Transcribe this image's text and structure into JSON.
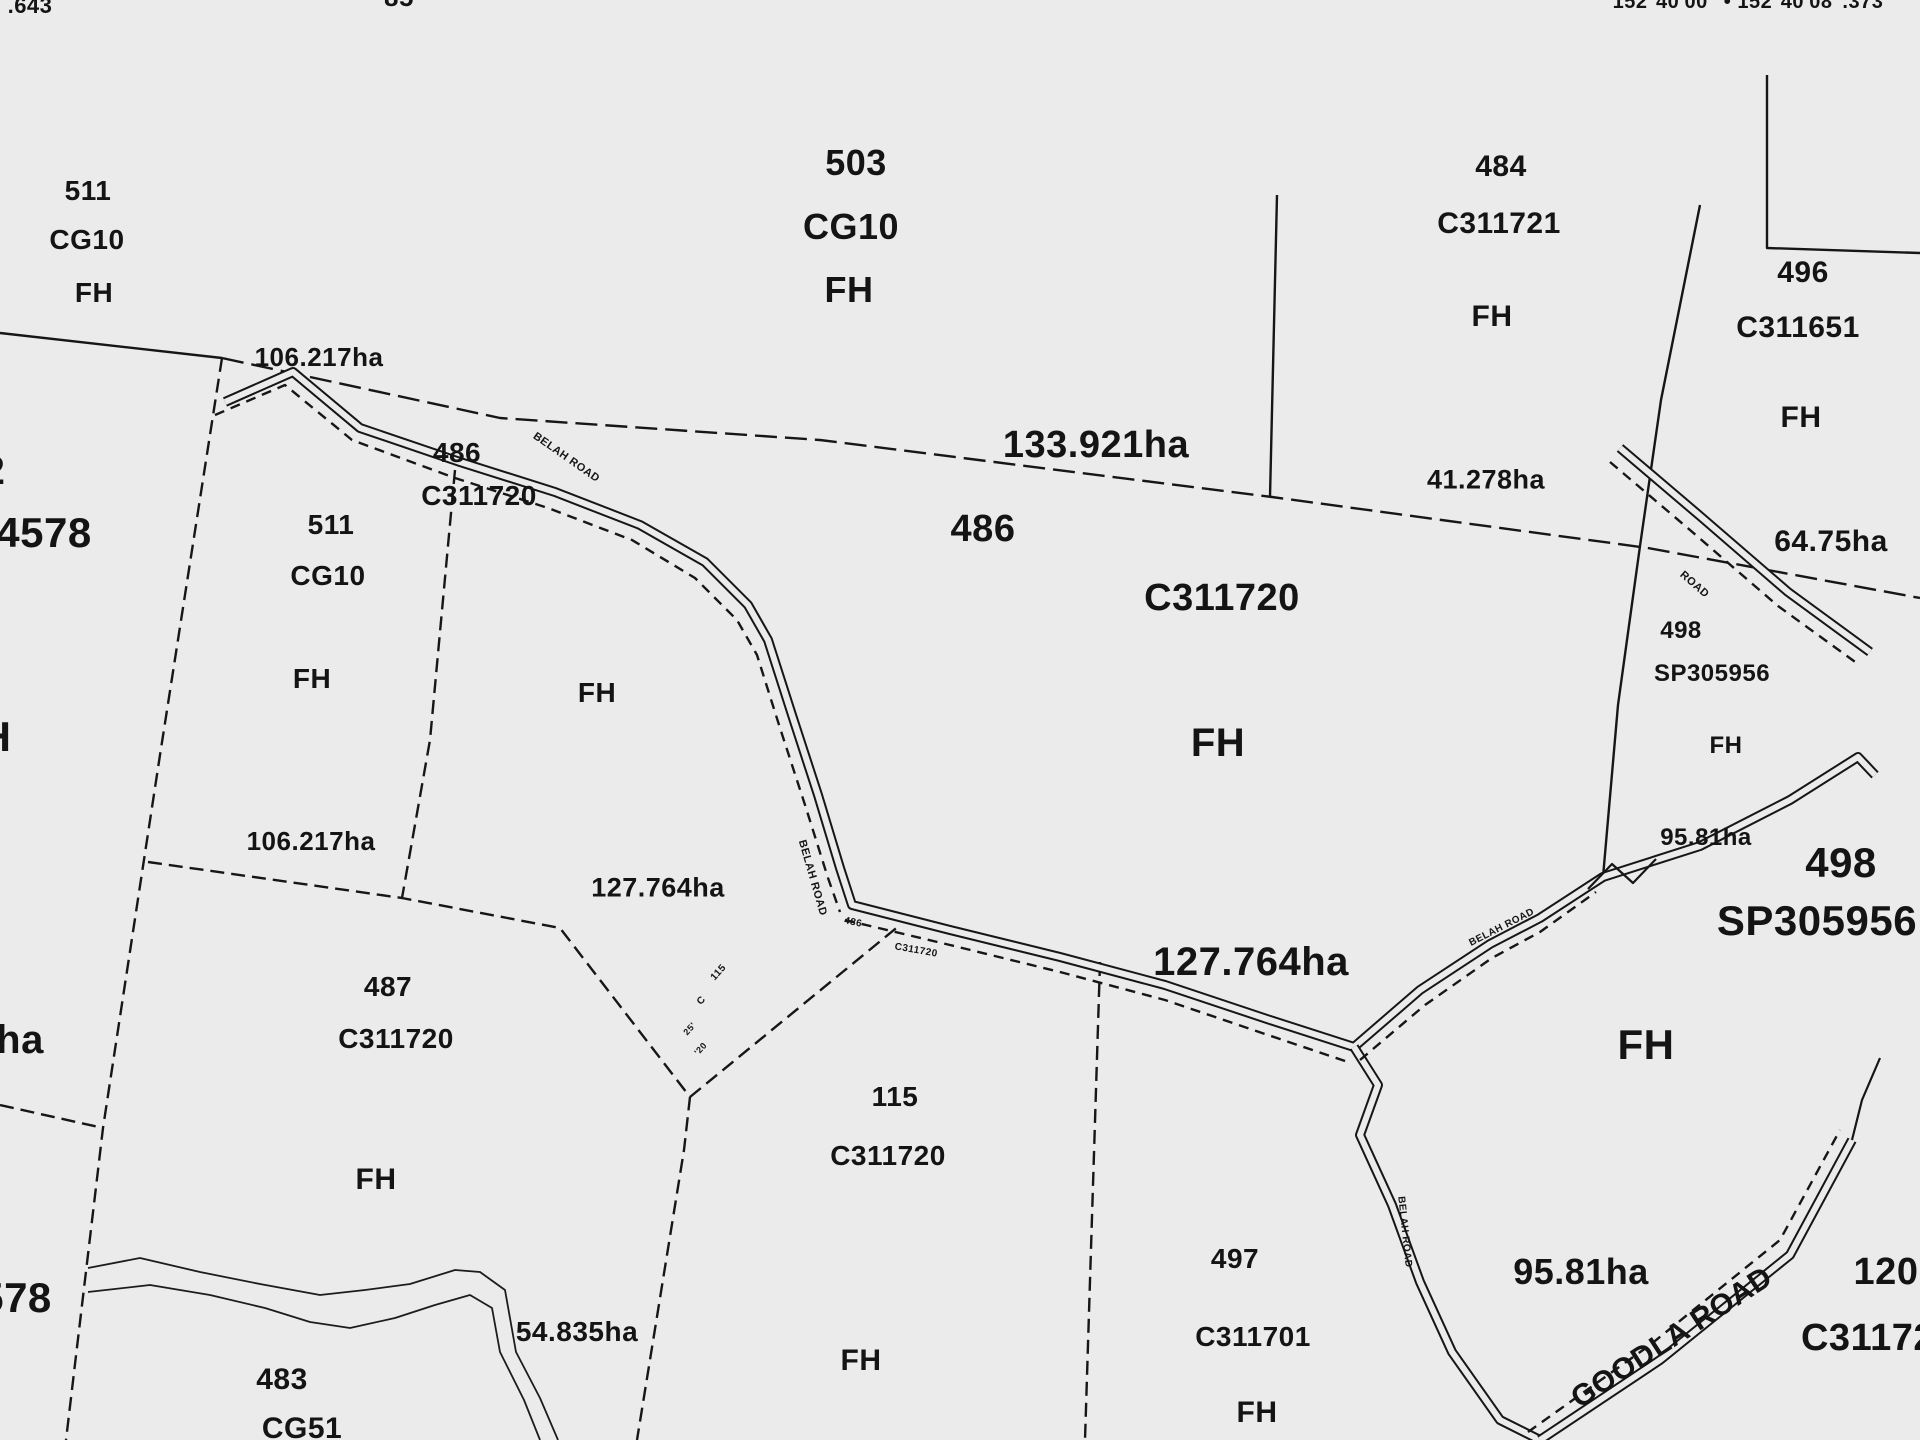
{
  "map_type": "cadastral parcel map",
  "ink_color": "#141414",
  "paper_color": "#ebebeb",
  "top_annotations": {
    "west_coordinate_fragment": ".643",
    "lot_fragment": "85",
    "north_arrow_fragment": "N",
    "longitude_labels": "152°40'00\" • 152°40'08\".373"
  },
  "parcels": [
    {
      "lot": "511",
      "plan": "CG10",
      "tenure": "FH",
      "area": "106.217ha"
    },
    {
      "lot": "503",
      "plan": "CG10",
      "tenure": "FH"
    },
    {
      "lot": "484",
      "plan": "C311721",
      "tenure": "FH"
    },
    {
      "lot": "496",
      "plan": "C311651",
      "tenure": "FH"
    },
    {
      "lot": "511",
      "plan": "CG10",
      "tenure": "FH",
      "area": "106.217ha"
    },
    {
      "lot": "486",
      "plan": "C311720",
      "tenure": "FH",
      "area": "133.921ha"
    },
    {
      "lot": "487",
      "plan": "C311720",
      "tenure": "FH",
      "area": "127.764ha"
    },
    {
      "lot": "115",
      "plan": "C311720",
      "tenure": "FH",
      "area": "54.835ha"
    },
    {
      "lot": "497",
      "plan": "C311701",
      "tenure": "FH",
      "area": "95.81ha"
    },
    {
      "lot": "498",
      "plan": "SP305956",
      "tenure": "FH",
      "area": "95.81ha"
    },
    {
      "lot": "483",
      "plan": "CG51"
    },
    {
      "lot": "120",
      "plan": "C31172"
    }
  ],
  "area_annotations": [
    "106.217ha",
    "133.921ha",
    "41.278ha",
    "64.75ha",
    "106.217ha",
    "127.764ha",
    "127.764ha",
    "95.81ha",
    "95.81ha",
    "54.835ha"
  ],
  "road_names": [
    "BELAH ROAD",
    "GOODLA ROAD"
  ],
  "labels": [
    {
      "n": "coord-fragment-west",
      "t": ".643",
      "x": 30,
      "y": 6,
      "s": 22
    },
    {
      "n": "lot-fragment-85",
      "t": "85",
      "x": 399,
      "y": -3,
      "s": 26
    },
    {
      "n": "north-arrow-icon",
      "t": "N",
      "x": 1057,
      "y": -16,
      "s": 46
    },
    {
      "n": "longitude-coordinates",
      "t": "152°40'00\" • 152°40'08\".373",
      "x": 1748,
      "y": 2,
      "s": 20
    },
    {
      "n": "parcel-511a-lot",
      "t": "511",
      "x": 88,
      "y": 191,
      "s": 28
    },
    {
      "n": "parcel-511a-plan",
      "t": "CG10",
      "x": 87,
      "y": 240,
      "s": 28
    },
    {
      "n": "parcel-511a-tenure",
      "t": "FH",
      "x": 94,
      "y": 293,
      "s": 28
    },
    {
      "n": "parcel-503-lot",
      "t": "503",
      "x": 856,
      "y": 163,
      "s": 36
    },
    {
      "n": "parcel-503-plan",
      "t": "CG10",
      "x": 851,
      "y": 227,
      "s": 36
    },
    {
      "n": "parcel-503-tenure",
      "t": "FH",
      "x": 849,
      "y": 290,
      "s": 36
    },
    {
      "n": "parcel-484-lot",
      "t": "484",
      "x": 1501,
      "y": 167,
      "s": 30
    },
    {
      "n": "parcel-484-plan",
      "t": "C311721",
      "x": 1499,
      "y": 224,
      "s": 30
    },
    {
      "n": "parcel-484-tenure",
      "t": "FH",
      "x": 1492,
      "y": 317,
      "s": 30
    },
    {
      "n": "parcel-496-lot",
      "t": "496",
      "x": 1803,
      "y": 273,
      "s": 30
    },
    {
      "n": "parcel-496-plan",
      "t": "C311651",
      "x": 1798,
      "y": 328,
      "s": 30
    },
    {
      "n": "parcel-496-tenure",
      "t": "FH",
      "x": 1801,
      "y": 418,
      "s": 30
    },
    {
      "n": "parcel-511b-lot",
      "t": "511",
      "x": 331,
      "y": 525,
      "s": 28
    },
    {
      "n": "parcel-511b-plan",
      "t": "CG10",
      "x": 328,
      "y": 576,
      "s": 28
    },
    {
      "n": "parcel-511b-tenure",
      "t": "FH",
      "x": 312,
      "y": 679,
      "s": 28
    },
    {
      "n": "parcel-486w-lot",
      "t": "486",
      "x": 457,
      "y": 453,
      "s": 28
    },
    {
      "n": "parcel-486w-plan",
      "t": "C311720",
      "x": 479,
      "y": 496,
      "s": 28
    },
    {
      "n": "parcel-486w-tenure",
      "t": "FH",
      "x": 597,
      "y": 693,
      "s": 28
    },
    {
      "n": "parcel-486-lot",
      "t": "486",
      "x": 983,
      "y": 529,
      "s": 38
    },
    {
      "n": "parcel-486-plan",
      "t": "C311720",
      "x": 1222,
      "y": 598,
      "s": 38
    },
    {
      "n": "parcel-486-tenure",
      "t": "FH",
      "x": 1218,
      "y": 743,
      "s": 40
    },
    {
      "n": "parcel-487-lot",
      "t": "487",
      "x": 388,
      "y": 987,
      "s": 28
    },
    {
      "n": "parcel-487-plan",
      "t": "C311720",
      "x": 396,
      "y": 1039,
      "s": 28
    },
    {
      "n": "parcel-487-tenure",
      "t": "FH",
      "x": 376,
      "y": 1180,
      "s": 30
    },
    {
      "n": "parcel-115-lot",
      "t": "115",
      "x": 895,
      "y": 1097,
      "s": 28
    },
    {
      "n": "parcel-115-plan",
      "t": "C311720",
      "x": 888,
      "y": 1156,
      "s": 28
    },
    {
      "n": "parcel-115-tenure",
      "t": "FH",
      "x": 861,
      "y": 1361,
      "s": 30
    },
    {
      "n": "parcel-497-lot",
      "t": "497",
      "x": 1235,
      "y": 1259,
      "s": 28
    },
    {
      "n": "parcel-497-plan",
      "t": "C311701",
      "x": 1253,
      "y": 1337,
      "s": 28
    },
    {
      "n": "parcel-497-tenure",
      "t": "FH",
      "x": 1257,
      "y": 1413,
      "s": 30
    },
    {
      "n": "parcel-498a-lot",
      "t": "498",
      "x": 1681,
      "y": 631,
      "s": 24
    },
    {
      "n": "parcel-498a-plan",
      "t": "SP305956",
      "x": 1712,
      "y": 674,
      "s": 24
    },
    {
      "n": "parcel-498a-tenure",
      "t": "FH",
      "x": 1726,
      "y": 746,
      "s": 24
    },
    {
      "n": "parcel-498b-lot",
      "t": "498",
      "x": 1841,
      "y": 863,
      "s": 42
    },
    {
      "n": "parcel-498b-plan",
      "t": "SP305956",
      "x": 1817,
      "y": 921,
      "s": 42
    },
    {
      "n": "parcel-498b-tenure",
      "t": "FH",
      "x": 1646,
      "y": 1045,
      "s": 42
    },
    {
      "n": "parcel-483-lot",
      "t": "483",
      "x": 282,
      "y": 1380,
      "s": 30
    },
    {
      "n": "parcel-483-plan",
      "t": "CG51",
      "x": 302,
      "y": 1429,
      "s": 30
    },
    {
      "n": "area-106a",
      "t": "106.217ha",
      "x": 319,
      "y": 357,
      "s": 26
    },
    {
      "n": "area-106b",
      "t": "106.217ha",
      "x": 311,
      "y": 841,
      "s": 26
    },
    {
      "n": "area-133",
      "t": "133.921ha",
      "x": 1096,
      "y": 445,
      "s": 38
    },
    {
      "n": "area-41",
      "t": "41.278ha",
      "x": 1486,
      "y": 480,
      "s": 27
    },
    {
      "n": "area-64",
      "t": "64.75ha",
      "x": 1831,
      "y": 542,
      "s": 30
    },
    {
      "n": "area-127a",
      "t": "127.764ha",
      "x": 658,
      "y": 888,
      "s": 27
    },
    {
      "n": "area-127b",
      "t": "127.764ha",
      "x": 1251,
      "y": 962,
      "s": 40
    },
    {
      "n": "area-95a",
      "t": "95.81ha",
      "x": 1706,
      "y": 838,
      "s": 24
    },
    {
      "n": "area-95b",
      "t": "95.81ha",
      "x": 1581,
      "y": 1272,
      "s": 36
    },
    {
      "n": "area-54",
      "t": "54.835ha",
      "x": 577,
      "y": 1332,
      "s": 28
    },
    {
      "n": "edge-fragment-2",
      "t": "2",
      "x": -6,
      "y": 471,
      "s": 40
    },
    {
      "n": "edge-fragment-4578",
      "t": "4578",
      "x": 44,
      "y": 533,
      "s": 42
    },
    {
      "n": "edge-fragment-h",
      "t": "H",
      "x": -4,
      "y": 737,
      "s": 42
    },
    {
      "n": "edge-fragment-ha",
      "t": "ha",
      "x": 20,
      "y": 1040,
      "s": 40
    },
    {
      "n": "edge-fragment-578",
      "t": "578",
      "x": 16,
      "y": 1298,
      "s": 42
    },
    {
      "n": "edge-fragment-120",
      "t": "120",
      "x": 1886,
      "y": 1272,
      "s": 38
    },
    {
      "n": "edge-fragment-c31172",
      "t": "C31172",
      "x": 1868,
      "y": 1338,
      "s": 38
    },
    {
      "n": "road-label-belah-1",
      "t": "BELAH ROAD",
      "x": 566,
      "y": 458,
      "s": 11,
      "r": 35
    },
    {
      "n": "road-label-belah-2",
      "t": "BELAH ROAD",
      "x": 812,
      "y": 878,
      "s": 11,
      "r": 74
    },
    {
      "n": "road-label-belah-3",
      "t": "BELAH ROAD",
      "x": 1502,
      "y": 928,
      "s": 10,
      "r": -27
    },
    {
      "n": "road-label-belah-4",
      "t": "BELAH ROAD",
      "x": 1404,
      "y": 1232,
      "s": 10,
      "r": 84
    },
    {
      "n": "road-label-road-ne",
      "t": "ROAD",
      "x": 1694,
      "y": 585,
      "s": 11,
      "r": 41
    },
    {
      "n": "road-label-goodla",
      "t": "GOODLA ROAD",
      "x": 1672,
      "y": 1338,
      "s": 30,
      "r": -33
    },
    {
      "n": "junction-label-486",
      "t": "486",
      "x": 853,
      "y": 923,
      "s": 10,
      "r": 12
    },
    {
      "n": "junction-label-c311720",
      "t": "C311720",
      "x": 916,
      "y": 951,
      "s": 10,
      "r": 10
    },
    {
      "n": "junction-label-115",
      "t": "115",
      "x": 719,
      "y": 973,
      "s": 10,
      "r": -48
    },
    {
      "n": "junction-label-c",
      "t": "C",
      "x": 702,
      "y": 1001,
      "s": 10,
      "r": -48
    },
    {
      "n": "junction-label-25",
      "t": "25'",
      "x": 690,
      "y": 1029,
      "s": 9,
      "r": -48
    },
    {
      "n": "junction-label-20",
      "t": "'20",
      "x": 701,
      "y": 1049,
      "s": 9,
      "r": -48
    }
  ]
}
